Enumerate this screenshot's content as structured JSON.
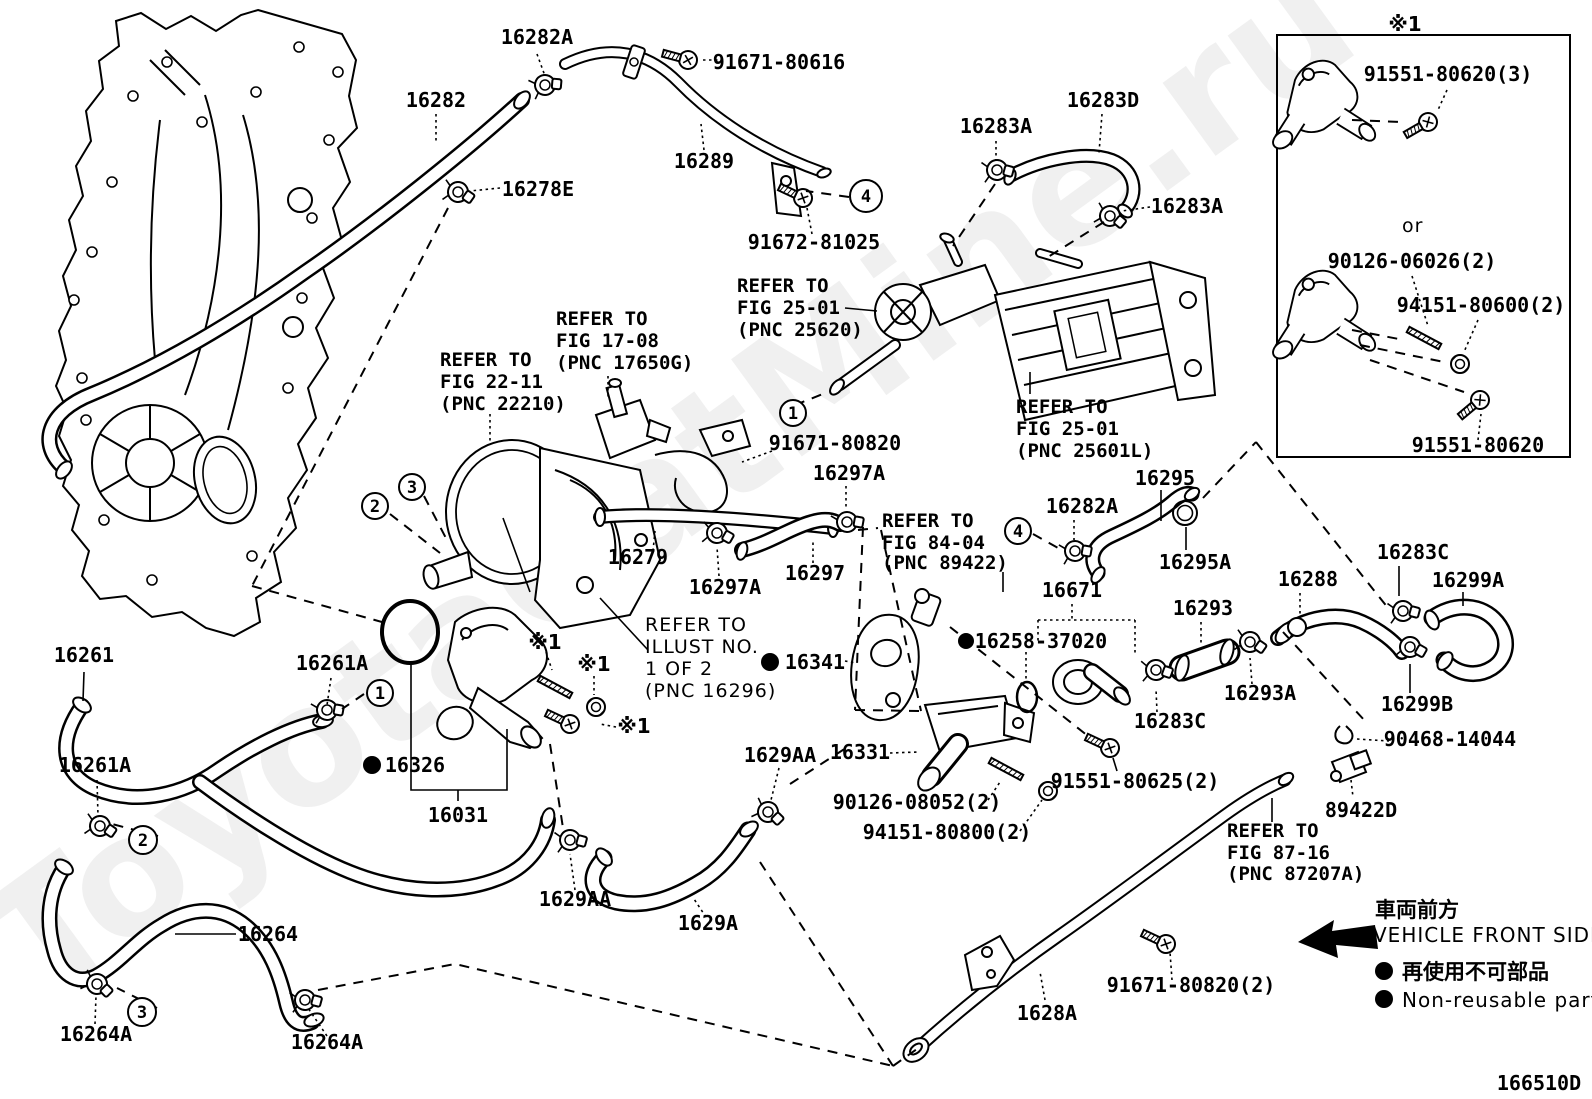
{
  "t": {
    "a16282A": "16282A",
    "a91671_80616": "91671-80616",
    "a16282": "16282",
    "a16289": "16289",
    "a16278E": "16278E",
    "a91672_81025": "91672-81025",
    "a16283A": "16283A",
    "a16283D": "16283D",
    "a91671_80820": "91671-80820",
    "a16297A": "16297A",
    "a16279": "16279",
    "a16297": "16297",
    "a16295": "16295",
    "a16295A": "16295A",
    "a16283C": "16283C",
    "a16299A": "16299A",
    "a16288": "16288",
    "a16293": "16293",
    "a16671": "16671",
    "a16258_37020": "16258-37020",
    "a16341": "16341",
    "a16293A": "16293A",
    "a16299B": "16299B",
    "a90468_14044": "90468-14044",
    "a89422D": "89422D",
    "a91551_80625": "91551-80625(2)",
    "a16261": "16261",
    "a16261A": "16261A",
    "a16326": "16326",
    "a16031": "16031",
    "a16264": "16264",
    "a16264A": "16264A",
    "a1629AA": "1629AA",
    "a1629A": "1629A",
    "a16331": "16331",
    "a90126_08052": "90126-08052(2)",
    "a94151_80800": "94151-80800(2)",
    "a91671_80820_2": "91671-80820(2)",
    "a1628A": "1628A",
    "star": "※1"
  },
  "refs": {
    "fig2501a": [
      "REFER TO",
      "FIG 25-01",
      "(PNC 25620)"
    ],
    "fig1708": [
      "REFER TO",
      "FIG 17-08",
      "(PNC 17650G)"
    ],
    "fig2211": [
      "REFER TO",
      "FIG 22-11",
      "(PNC 22210)"
    ],
    "fig2501b": [
      "REFER TO",
      "FIG 25-01",
      "(PNC 25601L)"
    ],
    "fig8404": [
      "REFER TO",
      "FIG 84-04",
      "(PNC 89422)"
    ],
    "illust": [
      "REFER TO",
      "ILLUST NO.",
      "1 OF 2",
      "(PNC 16296)"
    ],
    "fig8716": [
      "REFER TO",
      "FIG 87-16",
      "(PNC 87207A)"
    ]
  },
  "callouts": {
    "c1": "1",
    "c2": "2",
    "c3": "3",
    "c4": "4"
  },
  "inset": {
    "marker": "※1",
    "bolt3": "91551-80620(3)",
    "or_word": "or",
    "stud": "90126-06026(2)",
    "nut": "94151-80600(2)",
    "bolt": "91551-80620"
  },
  "legend": {
    "front_jp": "車両前方",
    "front_en": "VEHICLE FRONT SIDE",
    "nonreusable_jp": "再使用不可部品",
    "nonreusable_en": "Non-reusable part"
  },
  "watermark": "ToyotaCatMine.ru",
  "doc_number": "166510D"
}
